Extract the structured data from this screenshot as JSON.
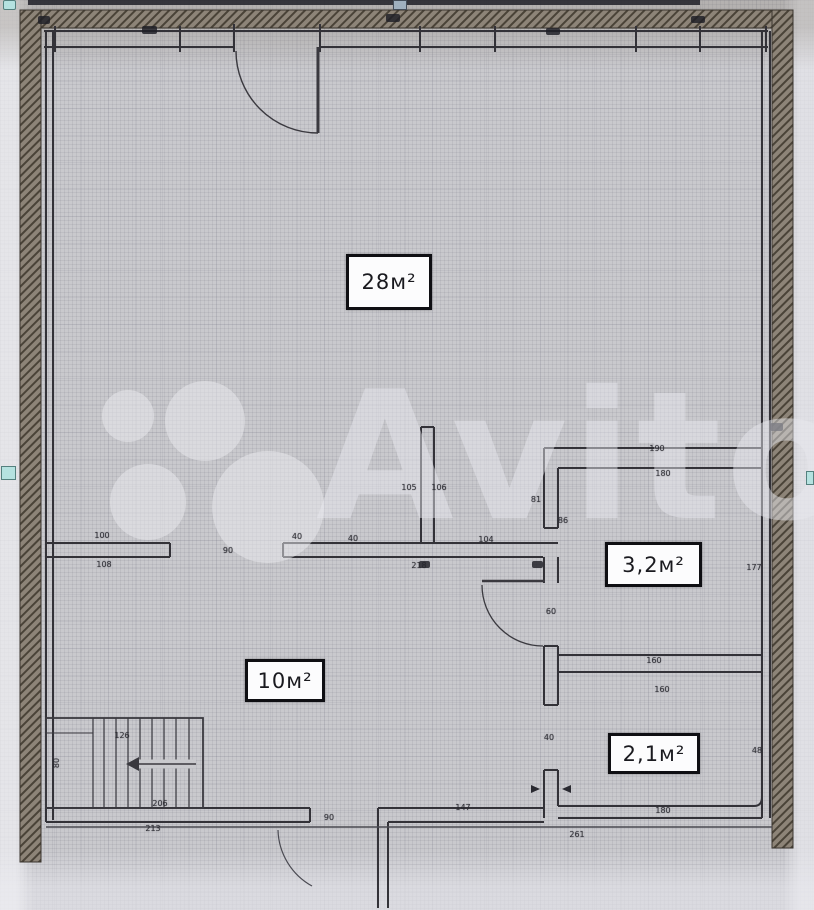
{
  "watermark": {
    "text": "Avito"
  },
  "rooms": [
    {
      "label": "28м²"
    },
    {
      "label": "3,2м²"
    },
    {
      "label": "10м²"
    },
    {
      "label": "2,1м²"
    }
  ],
  "dimensions": [
    {
      "text": "100",
      "x": 102,
      "y": 536
    },
    {
      "text": "108",
      "x": 104,
      "y": 565
    },
    {
      "text": "90",
      "x": 228,
      "y": 551
    },
    {
      "text": "40",
      "x": 297,
      "y": 537
    },
    {
      "text": "40",
      "x": 353,
      "y": 539
    },
    {
      "text": "104",
      "x": 486,
      "y": 540
    },
    {
      "text": "218",
      "x": 419,
      "y": 566
    },
    {
      "text": "105",
      "x": 409,
      "y": 488
    },
    {
      "text": "106",
      "x": 439,
      "y": 488
    },
    {
      "text": "81",
      "x": 536,
      "y": 500
    },
    {
      "text": "86",
      "x": 563,
      "y": 521
    },
    {
      "text": "190",
      "x": 657,
      "y": 449
    },
    {
      "text": "180",
      "x": 663,
      "y": 474
    },
    {
      "text": "177",
      "x": 754,
      "y": 568
    },
    {
      "text": "60",
      "x": 551,
      "y": 612
    },
    {
      "text": "160",
      "x": 654,
      "y": 661
    },
    {
      "text": "160",
      "x": 662,
      "y": 690
    },
    {
      "text": "40",
      "x": 549,
      "y": 738
    },
    {
      "text": "48",
      "x": 757,
      "y": 751
    },
    {
      "text": "126",
      "x": 122,
      "y": 736
    },
    {
      "text": "80",
      "x": 57,
      "y": 763,
      "rot": -90
    },
    {
      "text": "206",
      "x": 160,
      "y": 804
    },
    {
      "text": "213",
      "x": 153,
      "y": 829
    },
    {
      "text": "90",
      "x": 329,
      "y": 818
    },
    {
      "text": "147",
      "x": 463,
      "y": 808
    },
    {
      "text": "180",
      "x": 663,
      "y": 811
    },
    {
      "text": "261",
      "x": 577,
      "y": 835
    }
  ],
  "colors": {
    "paper": "#c9c9cd",
    "wall": "#333238",
    "outer_wall_hatch": "#8d8478",
    "handle_accent": "#b5e2e0",
    "label_border": "#0f0f13"
  }
}
